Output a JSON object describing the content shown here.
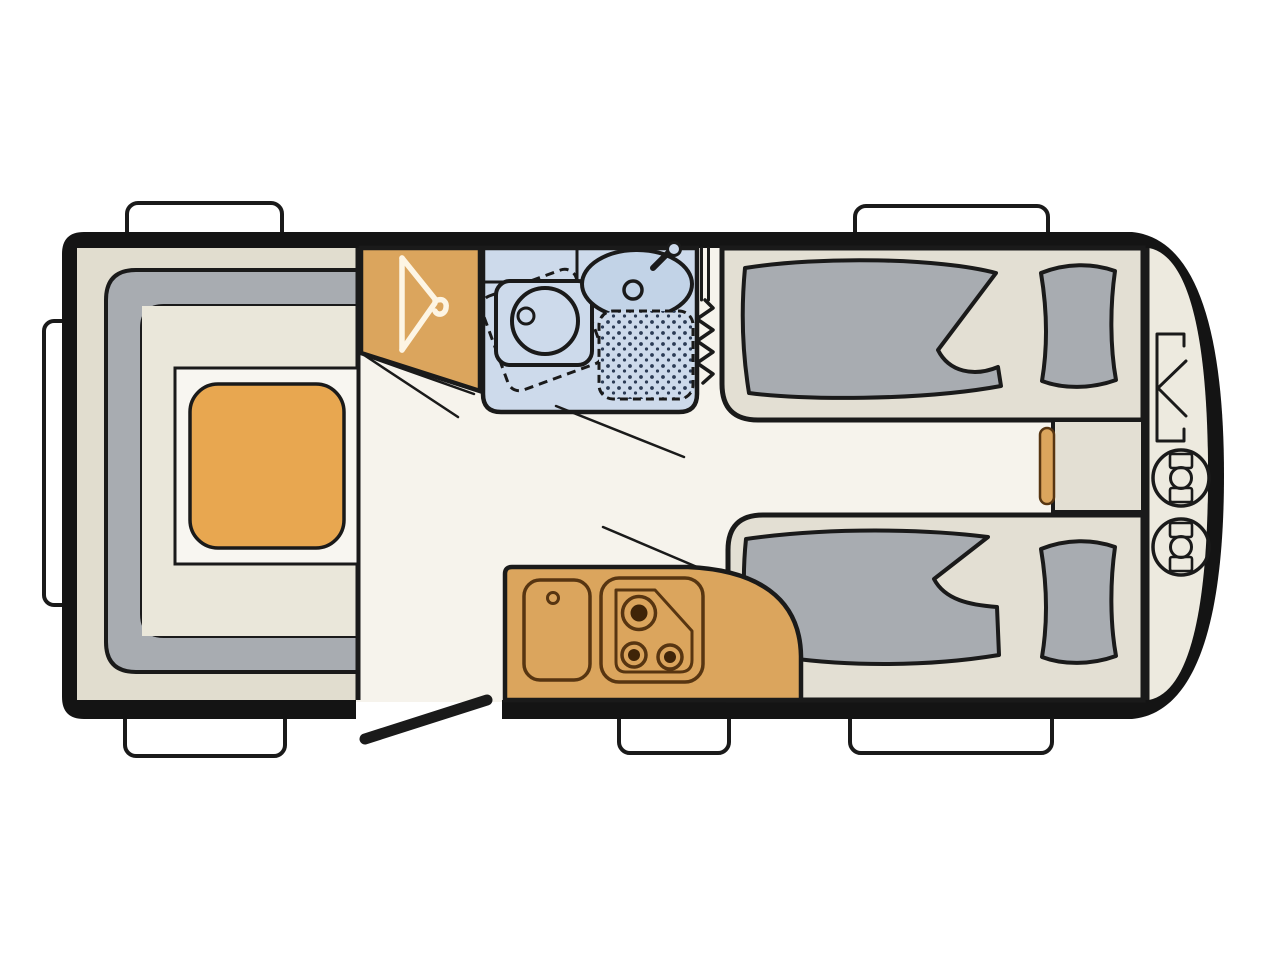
{
  "diagram": {
    "type": "caravan-floorplan",
    "orientation": "side-view-top-down, rear at left, rounded front at right",
    "zones": [
      {
        "id": "lounge-dinette",
        "name": "U-shaped lounge seating with dinette table"
      },
      {
        "id": "wardrobe",
        "name": "wardrobe with coat hanger symbol"
      },
      {
        "id": "washroom",
        "name": "washroom with basin, swivel toilet and shower"
      },
      {
        "id": "kitchen",
        "name": "kitchen unit with sink and three-burner hob"
      },
      {
        "id": "bed-top",
        "name": "single bed with duvet and pillow (top)"
      },
      {
        "id": "bed-bottom",
        "name": "single bed with duvet and pillow (bottom)"
      },
      {
        "id": "bedside-chest",
        "name": "chest between bed heads with drawer"
      },
      {
        "id": "front-locker",
        "name": "front gas locker with two gas bottles and hatch symbol"
      },
      {
        "id": "entrance",
        "name": "entrance door shown open on bottom wall"
      }
    ],
    "counts": {
      "windows": 6,
      "gas_bottles": 2,
      "hob_burners": 3,
      "beds": 2,
      "pillows": 2,
      "duvets": 2
    },
    "colors": {
      "background": "#ffffff",
      "wall": "#141414",
      "floor": "#f6f3ec",
      "lounge_floor": "#e1ddcf",
      "inner_floor": "#eae7da",
      "cushion_gray": "#a8acb1",
      "furniture_tan": "#dba55d",
      "table_orange": "#e8a750",
      "bathroom_blue": "#cddaeb",
      "basin_blue": "#c2d3e7",
      "bed_base": "#e3dfd3",
      "locker_floor": "#edeadf",
      "window_white": "#ffffff",
      "outline_dark": "#1a1a1a",
      "kitchen_outline": "#573511",
      "burner_dark": "#3f2408",
      "hanger_white": "#fdf5e4",
      "shower_dot": "#2b3b55"
    }
  }
}
